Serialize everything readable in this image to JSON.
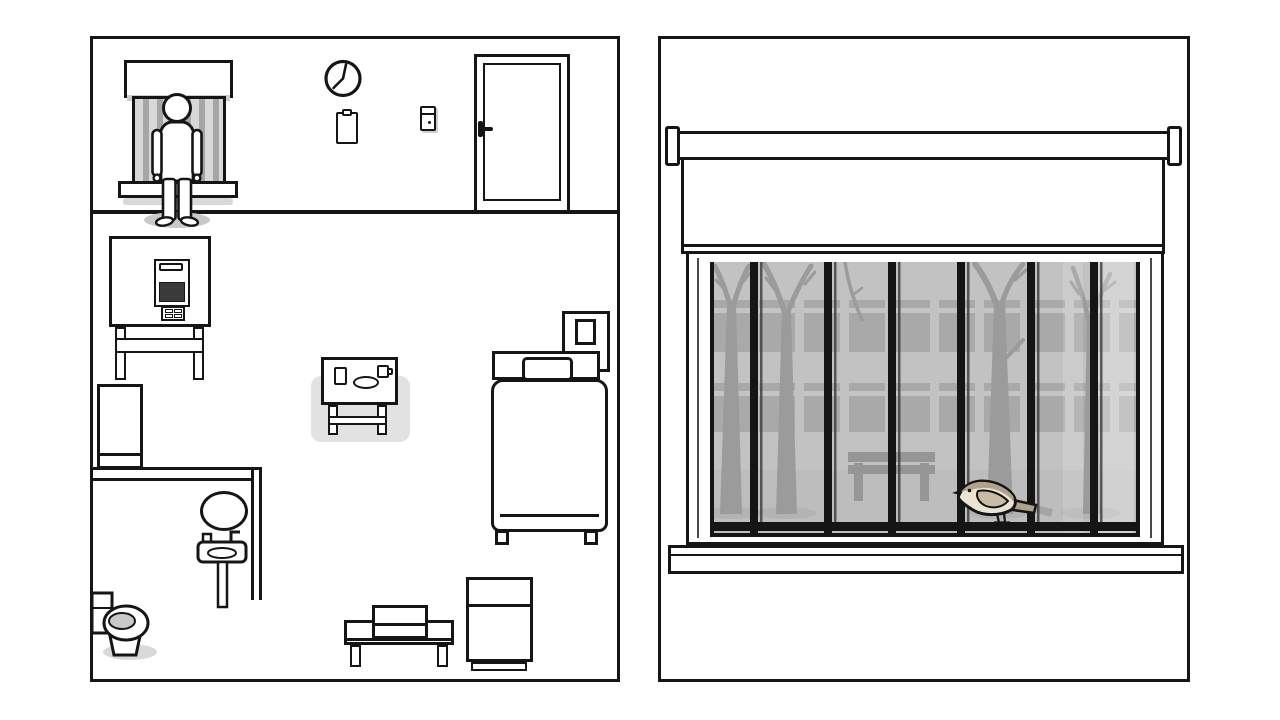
{
  "meta": {
    "scene": "two-panel room scene (patient room with barred window view)",
    "canvas": {
      "width": 1280,
      "height": 720
    }
  },
  "colors": {
    "ink": "#151515",
    "shadow": "#d9d9d9",
    "soft_shadow": "#c9c9c9",
    "tray_highlight": "#e2e2e2",
    "screen": "#3a3a3a",
    "small_window_bg": "#adadad",
    "small_window_bar_light": "#d8d8d8",
    "small_window_bar_dark": "#a6a6a6",
    "glass_facade": "#c2c2c2",
    "bldg_window": "#a9a9a9",
    "bldg_stripe": "#c4c4c4",
    "ground": "#bdbdbd",
    "ground_shadow": "#a9a9a9",
    "tree": "#9b9b9b",
    "bench_outside": "#969696",
    "bar": "#151515",
    "bar_thin": "#3a3a3a",
    "bird_back": "#b3a28a",
    "bird_belly": "#ece4d2",
    "bird_wing": "#c9bba4",
    "bird_tail_tip": "#a5a5a5",
    "toilet_water": "#c9c9c9"
  },
  "left_panel": {
    "name": "room-top-view",
    "clock": {
      "time": "7:05"
    },
    "inventory": [
      "patient",
      "barred-window",
      "wall-clock",
      "clipboard",
      "light-switch",
      "door",
      "machine-on-table",
      "fridge",
      "mirror",
      "sink",
      "toilet",
      "tray-table",
      "bed",
      "pillow",
      "nightstand",
      "bench-with-box",
      "cabinet"
    ],
    "tray_items": [
      "glass",
      "plate",
      "mug"
    ]
  },
  "right_panel": {
    "name": "window-close-up",
    "blind": {
      "state": "half-open"
    },
    "window": {
      "sash": {
        "w": 430,
        "h": 275
      },
      "bars_thick_x": [
        40,
        114,
        178,
        247,
        317,
        380
      ],
      "bars_thin_dx": 10,
      "bar_w": 8,
      "thin_w": 2.5,
      "bars_h": 260,
      "rail": {
        "y": 260,
        "h": 9
      },
      "stubs": {
        "y": 269,
        "h": 6
      },
      "building": {
        "rows": [
          {
            "y": 38,
            "h": 52
          },
          {
            "y": 121,
            "h": 49
          }
        ],
        "cols_x": [
          4,
          49,
          94,
          139,
          184,
          229,
          274,
          319,
          364,
          409
        ],
        "col_w": 36,
        "stripe_dy": 8,
        "stripe_h": 5
      },
      "ground_y": 208,
      "bench": {
        "x": 138,
        "y": 190,
        "w": 87
      },
      "tree_shadow_cx": [
        21,
        76,
        289,
        381
      ],
      "light_strips": [
        {
          "x": 353,
          "w": 20,
          "opacity": 0.15
        },
        {
          "x": 386,
          "w": 38,
          "opacity": 0.3
        }
      ],
      "trees": 4,
      "bird": {
        "species": "small songbird",
        "facing": "left",
        "perched_on": "window bars rail"
      }
    }
  }
}
